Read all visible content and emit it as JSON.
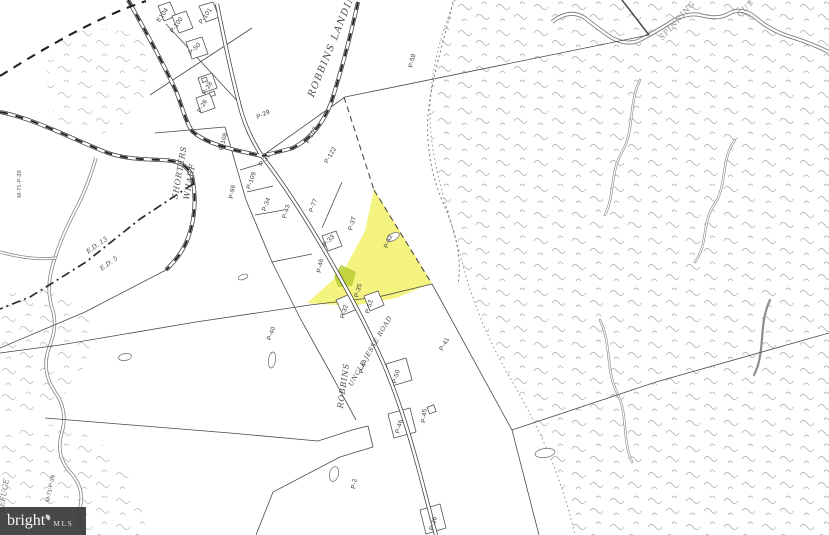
{
  "map": {
    "type": "tax-parcel-plat-map",
    "highlight_color": "#f4f164",
    "secondary_highlight_color": "#b9cc33",
    "highlighted_parcel": "P-42",
    "roads": {
      "robbins_landing": "ROBBINS LANDING",
      "shorters_1": "SHORTERS",
      "shorters_2": "WHARF",
      "robbins": "ROBBINS",
      "uncle_jesse": "UNCLE JESSE ROAD"
    },
    "waterways": {
      "creek_1": "SPINNING",
      "creek_2": "GUT"
    },
    "districts": {
      "ed13": "E.D. 13",
      "ed5": "E.D. 5"
    },
    "references": [
      "M-71-P-39",
      "M-71-P-39",
      "REFUGE"
    ],
    "parcels": [
      "E104",
      "P-100",
      "P-101",
      "P-50",
      "P-28",
      "P-26",
      "P-29",
      "P-107",
      "P-122",
      "P-58",
      "P-108",
      "P-96",
      "P-31",
      "P-109",
      "P-34",
      "P-43",
      "P-77",
      "P-37",
      "P-42",
      "P-33",
      "P-48",
      "P-35",
      "P-32",
      "P-52",
      "P-40",
      "P-44",
      "P-50",
      "P-46",
      "P-45",
      "P-41",
      "P-36",
      "P-2"
    ]
  },
  "watermark": {
    "brand": "bright",
    "suffix": "MLS"
  }
}
